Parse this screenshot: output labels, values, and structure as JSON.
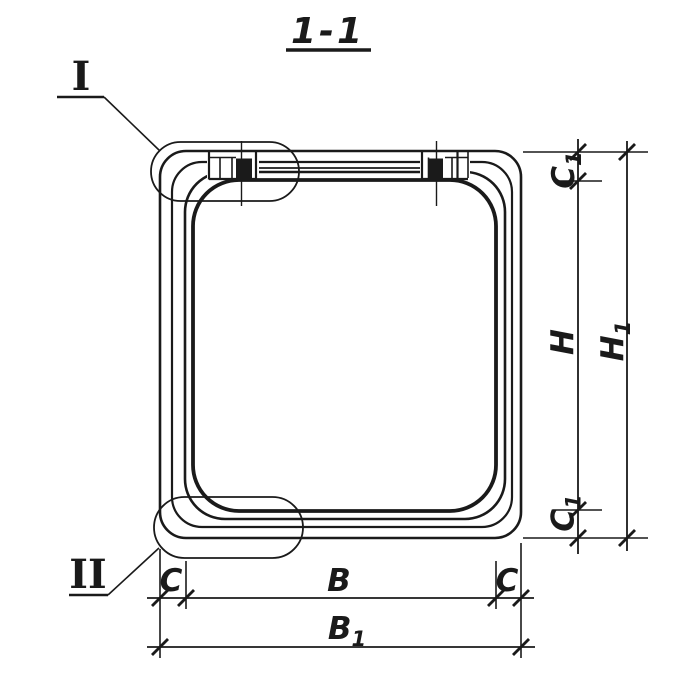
{
  "title": {
    "label": "1-1"
  },
  "callouts": {
    "detail_1": "I",
    "detail_2": "II"
  },
  "dims": {
    "c1_top": {
      "main": "C",
      "sub": "1"
    },
    "h": {
      "main": "H",
      "sub": ""
    },
    "h1": {
      "main": "H",
      "sub": "1"
    },
    "c1_bottom": {
      "main": "C",
      "sub": "1"
    },
    "c_left": {
      "main": "C",
      "sub": ""
    },
    "b": {
      "main": "B",
      "sub": ""
    },
    "c_right": {
      "main": "C",
      "sub": ""
    },
    "b1": {
      "main": "B",
      "sub": "1"
    }
  },
  "colors": {
    "ink": "#1a1a1a",
    "paper": "#ffffff"
  }
}
